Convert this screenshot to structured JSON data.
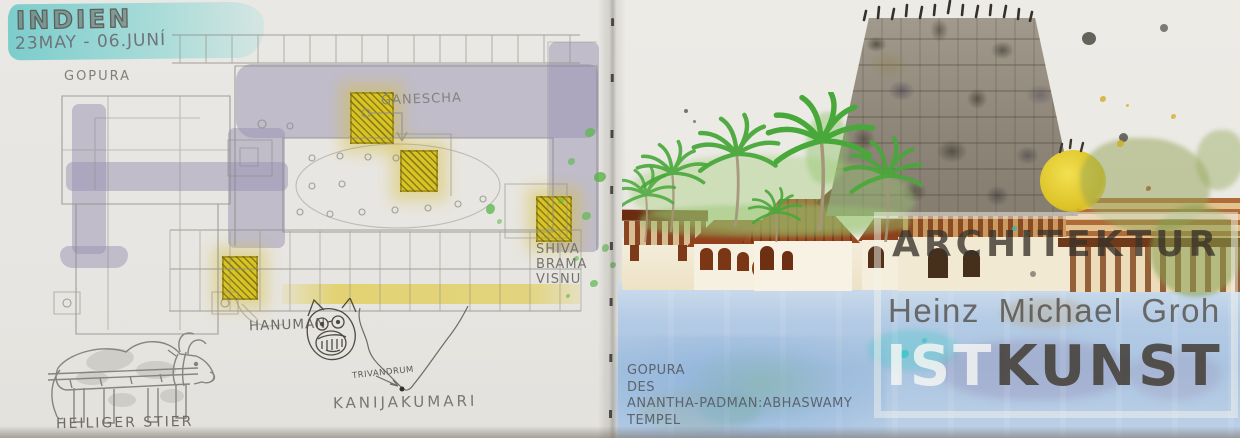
{
  "left_page": {
    "header": {
      "title": "INDIEN",
      "date_range": "23MAY - 06.JUNÍ"
    },
    "floor_plan": {
      "gopura_label": "GOPURA",
      "ganescha_label": "GANESCHA",
      "trinity_shrine": {
        "line1": "SHIVA",
        "line2": "BRAMA",
        "line3": "VISNU"
      },
      "hanuman_label": "HANUMAN"
    },
    "india_map": {
      "city_label": "TRIVANDRUM",
      "cape_label": "KANIJAKUMARI"
    },
    "bull_sketch": {
      "caption": "HEILIGER STIER"
    }
  },
  "right_page": {
    "caption": {
      "line1": "GOPURA",
      "line2": "DES",
      "line3": "ANANTHA-PADMAN:ABHASWAMY",
      "line4": "TEMPEL"
    }
  },
  "watermark": {
    "line1": "ARCHITEKTUR",
    "line2": "Heinz Michael Groh",
    "line3_light": "IST",
    "line3_dark": "KUNST"
  },
  "colors": {
    "paper": "#e9e7e3",
    "highlight_cyan": "#72ccc8",
    "plan_lavender": "#b7b3cb",
    "shrine_yellow": "#d8c322",
    "pencil_gray": "#85857f",
    "water_blue": "#aac4e0",
    "palm_green": "#48a83a",
    "roof_brown": "#93421d",
    "tower_gray": "#8d8577",
    "dome_yellow": "#dcc226",
    "watermark_dark": "#46413a",
    "watermark_light": "#f2f2ec"
  }
}
